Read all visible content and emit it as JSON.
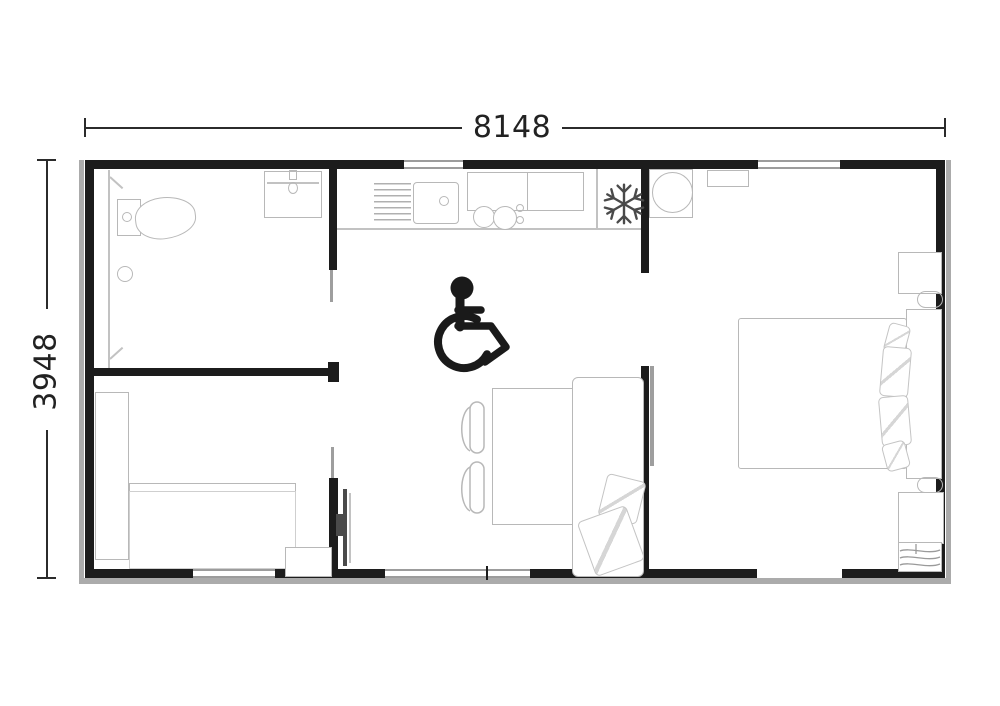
{
  "dimensions": {
    "width_label": "8148",
    "height_label": "3948"
  },
  "icons": {
    "accessibility": "wheelchair-accessibility",
    "freezer": "snowflake"
  },
  "colors": {
    "wall": "#1c1c1c",
    "furniture_line": "#b8b8b8",
    "dimension_line": "#2b2b2b",
    "icon_black": "#1a1a1a",
    "snowflake_gray": "#4a4a4a",
    "background": "#ffffff"
  }
}
